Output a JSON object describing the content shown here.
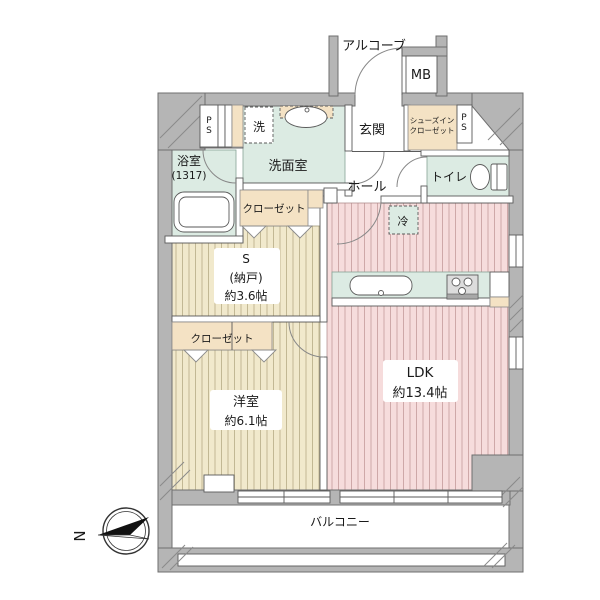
{
  "plan": {
    "compass": {
      "north_label": "N"
    },
    "alcove": {
      "label": "アルコーブ"
    },
    "meter_box": {
      "label": "MB"
    },
    "entrance": {
      "label": "玄関"
    },
    "shoes_in_closet": {
      "label_line1": "シューズイン",
      "label_line2": "クローゼット"
    },
    "pipe_shaft_right": {
      "letter_top": "P",
      "letter_bottom": "S"
    },
    "pipe_shaft_left": {
      "letter_top": "P",
      "letter_bottom": "S"
    },
    "washer": {
      "label": "洗"
    },
    "washroom": {
      "label": "洗面室"
    },
    "bathroom": {
      "name": "浴室",
      "size": "(1317)"
    },
    "hall": {
      "label": "ホール"
    },
    "toilet": {
      "label": "トイレ"
    },
    "refrigerator": {
      "label": "冷"
    },
    "storage_closet": {
      "label": "クローゼット"
    },
    "storage_room": {
      "name": "S",
      "sub": "(納戸)",
      "size": "約3.6帖"
    },
    "bedroom_closet": {
      "label": "クローゼット"
    },
    "bedroom": {
      "name": "洋室",
      "size": "約6.1帖"
    },
    "ldk": {
      "name": "LDK",
      "size": "約13.4帖"
    },
    "balcony": {
      "label": "バルコニー"
    },
    "colors": {
      "wall": "#b5b5b5",
      "wet_area": "#dcebe3",
      "ldk_floor": "#f6dcdc",
      "ldk_stripe": "#c49b9b",
      "room_floor": "#f1e9cc",
      "room_stripe": "#b6ac86",
      "closet": "#f4e2c4",
      "background": "#ffffff"
    }
  }
}
